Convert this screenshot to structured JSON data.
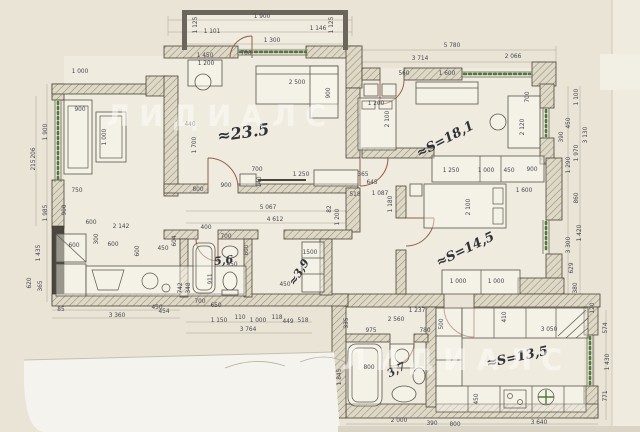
{
  "watermark": {
    "text": "ЛИДИАЛС",
    "positions": [
      {
        "x": 106,
        "y": 126
      },
      {
        "x": 342,
        "y": 370
      }
    ]
  },
  "room_labels": [
    {
      "t": "≈23.5",
      "x": 244,
      "y": 138,
      "r": -8,
      "s": 16
    },
    {
      "t": "≈S=18,1",
      "x": 447,
      "y": 143,
      "r": -28,
      "s": 13
    },
    {
      "t": "≈S=14,5",
      "x": 467,
      "y": 253,
      "r": -26,
      "s": 13
    },
    {
      "t": "≈S=13,5",
      "x": 518,
      "y": 361,
      "r": -12,
      "s": 13
    },
    {
      "t": "5,6",
      "x": 224,
      "y": 264,
      "r": -6,
      "s": 11
    },
    {
      "t": "≈3,9",
      "x": 302,
      "y": 274,
      "r": -58,
      "s": 11
    },
    {
      "t": "3,7",
      "x": 398,
      "y": 373,
      "r": -28,
      "s": 11
    }
  ],
  "dimensions": [
    {
      "t": "1 125",
      "x": 197,
      "y": 25,
      "r": -90
    },
    {
      "t": "1 900",
      "x": 262,
      "y": 18
    },
    {
      "t": "1 101",
      "x": 212,
      "y": 33
    },
    {
      "t": "1 146",
      "x": 318,
      "y": 30
    },
    {
      "t": "1 125",
      "x": 333,
      "y": 25,
      "r": -90
    },
    {
      "t": "1 300",
      "x": 272,
      "y": 42
    },
    {
      "t": "700",
      "x": 246,
      "y": 55
    },
    {
      "t": "5 780",
      "x": 452,
      "y": 47
    },
    {
      "t": "3 714",
      "x": 420,
      "y": 60
    },
    {
      "t": "2 066",
      "x": 513,
      "y": 58
    },
    {
      "t": "560",
      "x": 404,
      "y": 75
    },
    {
      "t": "1 600",
      "x": 447,
      "y": 75
    },
    {
      "t": "1 100",
      "x": 578,
      "y": 97,
      "r": -90
    },
    {
      "t": "1 450",
      "x": 205,
      "y": 57
    },
    {
      "t": "1 200",
      "x": 206,
      "y": 65
    },
    {
      "t": "2 500",
      "x": 297,
      "y": 84
    },
    {
      "t": "900",
      "x": 330,
      "y": 93,
      "r": -90
    },
    {
      "t": "440",
      "x": 190,
      "y": 126
    },
    {
      "t": "1 700",
      "x": 196,
      "y": 145,
      "r": -90
    },
    {
      "t": "700",
      "x": 257,
      "y": 171
    },
    {
      "t": "140",
      "x": 261,
      "y": 182,
      "r": -90
    },
    {
      "t": "1 250",
      "x": 301,
      "y": 176
    },
    {
      "t": "900",
      "x": 226,
      "y": 187
    },
    {
      "t": "800",
      "x": 198,
      "y": 191
    },
    {
      "t": "1 000",
      "x": 80,
      "y": 73
    },
    {
      "t": "900",
      "x": 80,
      "y": 111
    },
    {
      "t": "1 000",
      "x": 106,
      "y": 137,
      "r": -90
    },
    {
      "t": "1 900",
      "x": 47,
      "y": 132,
      "r": -90
    },
    {
      "t": "206",
      "x": 35,
      "y": 153,
      "r": -90
    },
    {
      "t": "215",
      "x": 35,
      "y": 165,
      "r": -90
    },
    {
      "t": "1 985",
      "x": 47,
      "y": 213,
      "r": -90
    },
    {
      "t": "750",
      "x": 77,
      "y": 192
    },
    {
      "t": "900",
      "x": 66,
      "y": 210,
      "r": -90
    },
    {
      "t": "600",
      "x": 91,
      "y": 224
    },
    {
      "t": "2 142",
      "x": 121,
      "y": 228
    },
    {
      "t": "600",
      "x": 74,
      "y": 247
    },
    {
      "t": "600",
      "x": 113,
      "y": 246
    },
    {
      "t": "300",
      "x": 98,
      "y": 239,
      "r": -90
    },
    {
      "t": "600",
      "x": 139,
      "y": 251,
      "r": -90
    },
    {
      "t": "450",
      "x": 163,
      "y": 250
    },
    {
      "t": "604",
      "x": 176,
      "y": 241,
      "r": -90
    },
    {
      "t": "1 435",
      "x": 40,
      "y": 253,
      "r": -90
    },
    {
      "t": "620",
      "x": 31,
      "y": 283,
      "r": -90
    },
    {
      "t": "365",
      "x": 42,
      "y": 286,
      "r": -90
    },
    {
      "t": "450",
      "x": 157,
      "y": 309
    },
    {
      "t": "85",
      "x": 61,
      "y": 311
    },
    {
      "t": "3 360",
      "x": 117,
      "y": 317
    },
    {
      "t": "454",
      "x": 164,
      "y": 313
    },
    {
      "t": "742",
      "x": 182,
      "y": 288,
      "r": -90
    },
    {
      "t": "348",
      "x": 190,
      "y": 288,
      "r": -90
    },
    {
      "t": "400",
      "x": 206,
      "y": 229
    },
    {
      "t": "700",
      "x": 226,
      "y": 238
    },
    {
      "t": "600",
      "x": 248,
      "y": 250,
      "r": -90
    },
    {
      "t": "450",
      "x": 232,
      "y": 266
    },
    {
      "t": "911",
      "x": 212,
      "y": 279,
      "r": -90
    },
    {
      "t": "450",
      "x": 285,
      "y": 286
    },
    {
      "t": "1500",
      "x": 310,
      "y": 254
    },
    {
      "t": "700",
      "x": 200,
      "y": 303
    },
    {
      "t": "650",
      "x": 216,
      "y": 307
    },
    {
      "t": "5 067",
      "x": 268,
      "y": 209
    },
    {
      "t": "4 612",
      "x": 275,
      "y": 221
    },
    {
      "t": "82",
      "x": 331,
      "y": 209,
      "r": -90
    },
    {
      "t": "1 200",
      "x": 339,
      "y": 217,
      "r": -90
    },
    {
      "t": "1 150",
      "x": 219,
      "y": 322
    },
    {
      "t": "110",
      "x": 240,
      "y": 319
    },
    {
      "t": "1 000",
      "x": 258,
      "y": 322
    },
    {
      "t": "118",
      "x": 277,
      "y": 319
    },
    {
      "t": "449",
      "x": 288,
      "y": 323
    },
    {
      "t": "518",
      "x": 303,
      "y": 322
    },
    {
      "t": "3 764",
      "x": 248,
      "y": 331
    },
    {
      "t": "1 200",
      "x": 376,
      "y": 105
    },
    {
      "t": "2 100",
      "x": 389,
      "y": 119,
      "r": -90
    },
    {
      "t": "700",
      "x": 529,
      "y": 97,
      "r": -90
    },
    {
      "t": "2 120",
      "x": 524,
      "y": 127,
      "r": -90
    },
    {
      "t": "365",
      "x": 363,
      "y": 176
    },
    {
      "t": "645",
      "x": 372,
      "y": 184
    },
    {
      "t": "518",
      "x": 355,
      "y": 196
    },
    {
      "t": "1 087",
      "x": 380,
      "y": 195
    },
    {
      "t": "1 180",
      "x": 392,
      "y": 204,
      "r": -90
    },
    {
      "t": "1 250",
      "x": 451,
      "y": 172
    },
    {
      "t": "1 000",
      "x": 486,
      "y": 172
    },
    {
      "t": "450",
      "x": 509,
      "y": 172
    },
    {
      "t": "900",
      "x": 532,
      "y": 171
    },
    {
      "t": "1 600",
      "x": 524,
      "y": 192
    },
    {
      "t": "2 100",
      "x": 470,
      "y": 207,
      "r": -90
    },
    {
      "t": "1 000",
      "x": 458,
      "y": 283
    },
    {
      "t": "1 000",
      "x": 496,
      "y": 283
    },
    {
      "t": "450",
      "x": 570,
      "y": 123,
      "r": -90
    },
    {
      "t": "390",
      "x": 563,
      "y": 137,
      "r": -90
    },
    {
      "t": "3 130",
      "x": 587,
      "y": 135,
      "r": -90
    },
    {
      "t": "1 970",
      "x": 578,
      "y": 153,
      "r": -90
    },
    {
      "t": "1 290",
      "x": 570,
      "y": 165,
      "r": -90
    },
    {
      "t": "860",
      "x": 578,
      "y": 198,
      "r": -90
    },
    {
      "t": "1 420",
      "x": 581,
      "y": 233,
      "r": -90
    },
    {
      "t": "3 300",
      "x": 570,
      "y": 245,
      "r": -90
    },
    {
      "t": "629",
      "x": 573,
      "y": 268,
      "r": -90
    },
    {
      "t": "380",
      "x": 577,
      "y": 288,
      "r": -90
    },
    {
      "t": "120",
      "x": 594,
      "y": 308,
      "r": -90
    },
    {
      "t": "574",
      "x": 607,
      "y": 328,
      "r": -90
    },
    {
      "t": "1 430",
      "x": 609,
      "y": 362,
      "r": -90
    },
    {
      "t": "771",
      "x": 607,
      "y": 396,
      "r": -90
    },
    {
      "t": "1 237",
      "x": 417,
      "y": 312
    },
    {
      "t": "2 560",
      "x": 396,
      "y": 321
    },
    {
      "t": "335",
      "x": 348,
      "y": 323,
      "r": -90
    },
    {
      "t": "975",
      "x": 371,
      "y": 332
    },
    {
      "t": "780",
      "x": 425,
      "y": 332
    },
    {
      "t": "500",
      "x": 443,
      "y": 324,
      "r": -90
    },
    {
      "t": "410",
      "x": 506,
      "y": 317,
      "r": -90
    },
    {
      "t": "3 050",
      "x": 549,
      "y": 331
    },
    {
      "t": "800",
      "x": 369,
      "y": 369
    },
    {
      "t": "1 845",
      "x": 341,
      "y": 377,
      "r": -90
    },
    {
      "t": "450",
      "x": 478,
      "y": 399,
      "r": -90
    },
    {
      "t": "2 000",
      "x": 399,
      "y": 422
    },
    {
      "t": "390",
      "x": 432,
      "y": 425
    },
    {
      "t": "800",
      "x": 455,
      "y": 426
    },
    {
      "t": "3 640",
      "x": 539,
      "y": 424
    }
  ],
  "colors": {
    "paper": "#e9e4d6",
    "paper_light": "#efebde",
    "sheet": "#f5f3ee",
    "ink": "#30313a",
    "dim": "#45454f",
    "wall_line": "#4a4437",
    "plant": "#4f7a3a",
    "door": "#96604a",
    "furn": "#5a554b",
    "wm": "rgba(252,252,248,0.55)",
    "guide": "#a8a292"
  }
}
